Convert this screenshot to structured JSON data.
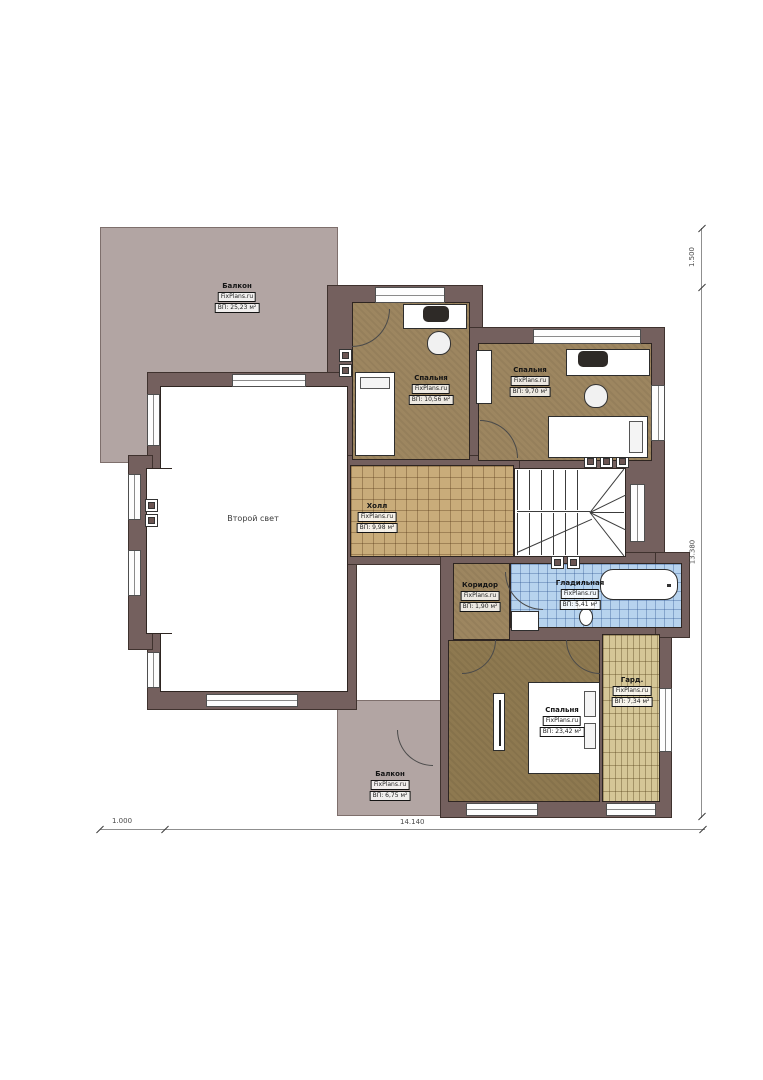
{
  "brand": "FixPlans.ru",
  "rooms": {
    "balcony_top": {
      "name": "Балкон",
      "brand": "FixPlans.ru",
      "area": "ВП: 25,23 м²"
    },
    "bedroom_top_left": {
      "name": "Спальня",
      "brand": "FixPlans.ru",
      "area": "ВП: 10,56 м²"
    },
    "bedroom_top_right": {
      "name": "Спальня",
      "brand": "FixPlans.ru",
      "area": "ВП: 9,70 м²"
    },
    "hall": {
      "name": "Холл",
      "brand": "FixPlans.ru",
      "area": "ВП: 9,98 м²"
    },
    "second_light": {
      "name": "Второй свет"
    },
    "corridor": {
      "name": "Коридор",
      "brand": "FixPlans.ru",
      "area": "ВП: 1,90 м²"
    },
    "ironing": {
      "name": "Гладильная",
      "brand": "FixPlans.ru",
      "area": "ВП: 5,41 м²"
    },
    "bedroom_master": {
      "name": "Спальня",
      "brand": "FixPlans.ru",
      "area": "ВП: 23,42 м²"
    },
    "wardrobe": {
      "name": "Гард.",
      "brand": "FixPlans.ru",
      "area": "ВП: 7,34 м²"
    },
    "balcony_bottom": {
      "name": "Балкон",
      "brand": "FixPlans.ru",
      "area": "ВП: 6,75 м²"
    }
  },
  "dimensions": {
    "right_top": "1.500",
    "right_main": "13.380",
    "bottom_left": "1.000",
    "bottom_main": "14.140"
  },
  "colors": {
    "wall": "#74605e",
    "balcony": "#b2a5a3",
    "bedroom_floor": "#9d8660",
    "master_floor": "#8e7950",
    "hall_tile": "#c9ac7a",
    "ironing_tile": "#b7d3ee",
    "wardrobe_floor": "#d5c697"
  }
}
